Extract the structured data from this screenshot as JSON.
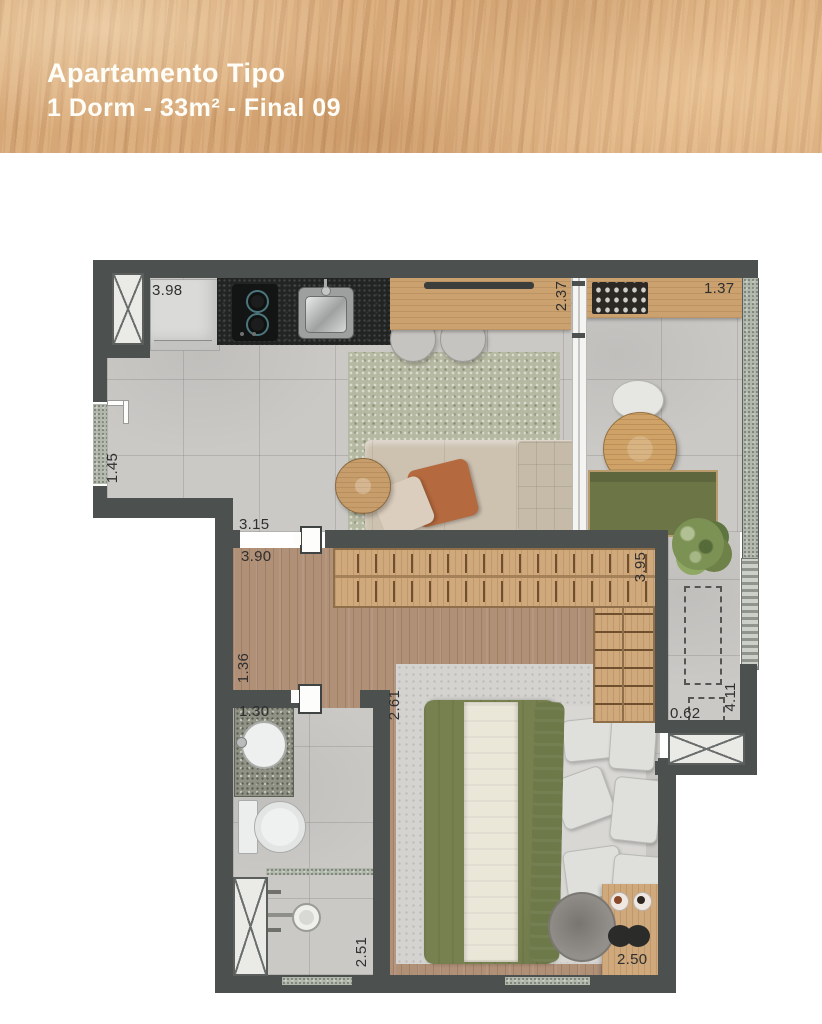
{
  "header": {
    "title": "Apartamento Tipo",
    "subtitle": "1 Dorm - 33m² - Final 09"
  },
  "plan": {
    "dims": {
      "kitchen_wall": "3.98",
      "living_glass": "2.37",
      "balcony_width": "1.37",
      "entry_wall": "1.45",
      "living_width": "3.15",
      "bedroom_width": "3.90",
      "closet_wall": "3.95",
      "hall_depth": "1.36",
      "bath_width": "1.30",
      "bedroom_depth": "2.61",
      "ac_ledge_width": "0.62",
      "balcony_depth": "4.11",
      "bath_depth": "2.51",
      "bed_wall": "2.50"
    },
    "colors": {
      "wall": "#4c5150",
      "tile_floor": "#cbc9c6",
      "wood_floor": "#b19078",
      "furniture_wood": "#cfa87b",
      "accent_green": "#6b7546",
      "header_wood": "#d9ab7c"
    }
  }
}
